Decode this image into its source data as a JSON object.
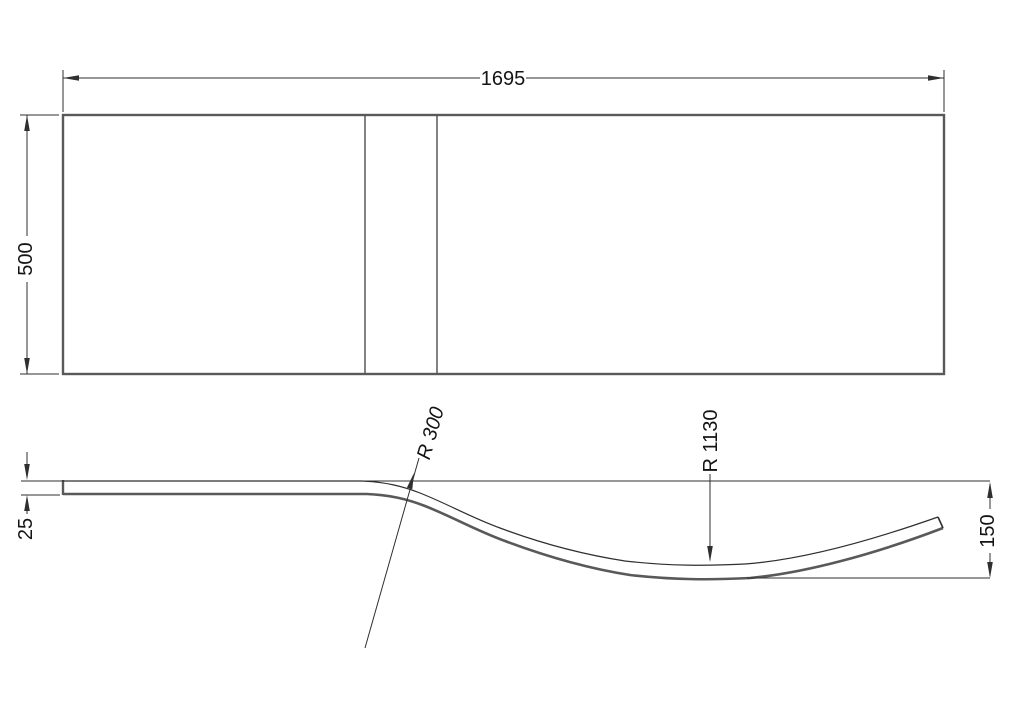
{
  "drawing": {
    "type": "technical-drawing",
    "views": {
      "plan": {
        "width_dim": "1695",
        "height_dim": "500"
      },
      "profile": {
        "thickness_dim": "25",
        "end_height_dim": "150",
        "radius_upper": "R 300",
        "radius_lower": "R 1130"
      }
    }
  },
  "colors": {
    "background": "#ffffff",
    "object_outline": "#58595b",
    "object_line": "#2f2f2f",
    "dimension": "#2f2f2f",
    "text": "#141414"
  }
}
